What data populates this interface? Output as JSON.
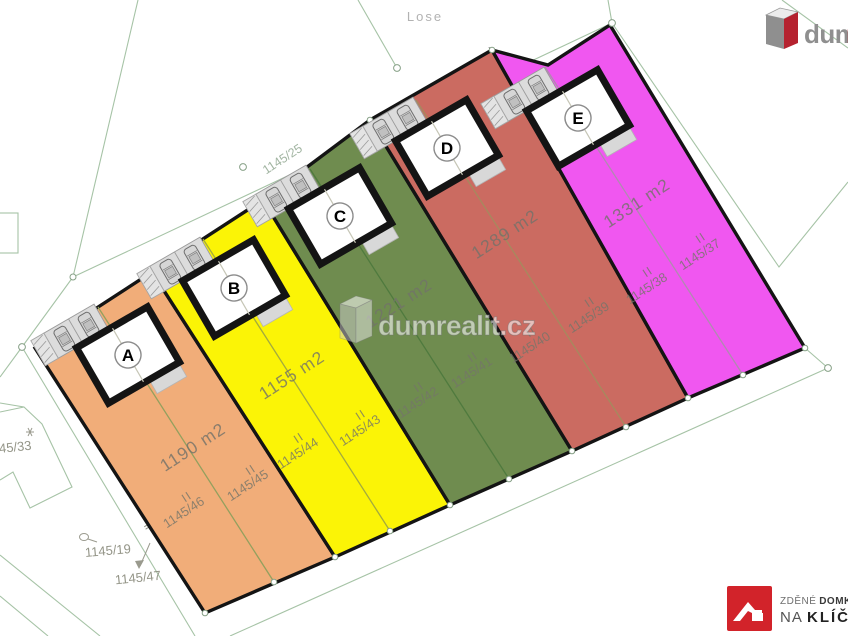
{
  "background": {
    "street_label": "Lose",
    "road_parcel": "1145/25",
    "neighbor_parcel_left": "1145/33",
    "neighbor_parcel_bottom": "1145/19",
    "sliver_parcel": "1145/47",
    "sliver_mark": "II"
  },
  "plots": [
    {
      "letter": "A",
      "area": "1190 m2",
      "color": "#f1ad79",
      "parcels": [
        {
          "mark": "II",
          "number": "1145/45"
        },
        {
          "mark": "II",
          "number": "1145/46"
        }
      ]
    },
    {
      "letter": "B",
      "area": "1155 m2",
      "color": "#fbf406",
      "parcels": [
        {
          "mark": "II",
          "number": "1145/43"
        },
        {
          "mark": "II",
          "number": "1145/44"
        }
      ]
    },
    {
      "letter": "C",
      "area": "1221 m2",
      "color": "#6f8c4f",
      "parcels": [
        {
          "mark": "II",
          "number": "1145/41"
        },
        {
          "mark": "II",
          "number": "1145/42"
        }
      ]
    },
    {
      "letter": "D",
      "area": "1289 m2",
      "color": "#cb6b61",
      "parcels": [
        {
          "mark": "II",
          "number": "1145/39"
        },
        {
          "mark": "II",
          "number": "1145/40"
        }
      ]
    },
    {
      "letter": "E",
      "area": "1331 m2",
      "color": "#f057f0",
      "parcels": [
        {
          "mark": "II",
          "number": "1145/37"
        },
        {
          "mark": "II",
          "number": "1145/38"
        }
      ]
    }
  ],
  "watermark": {
    "text": "dumrealit.cz"
  },
  "logo_top_right": {
    "text_gray": "dum",
    "text_red": "realit.cz"
  },
  "logo_bottom_right": {
    "line1_regular": "ZDĚNÉ",
    "line1_bold": "DOMKY",
    "registered": "®",
    "line2_regular": "NA",
    "line2_bold": "KLÍČ"
  },
  "colors": {
    "plot_border": "#141414",
    "cadastral_line": "#a6c3a6",
    "builder_logo_red": "#d2232a"
  }
}
